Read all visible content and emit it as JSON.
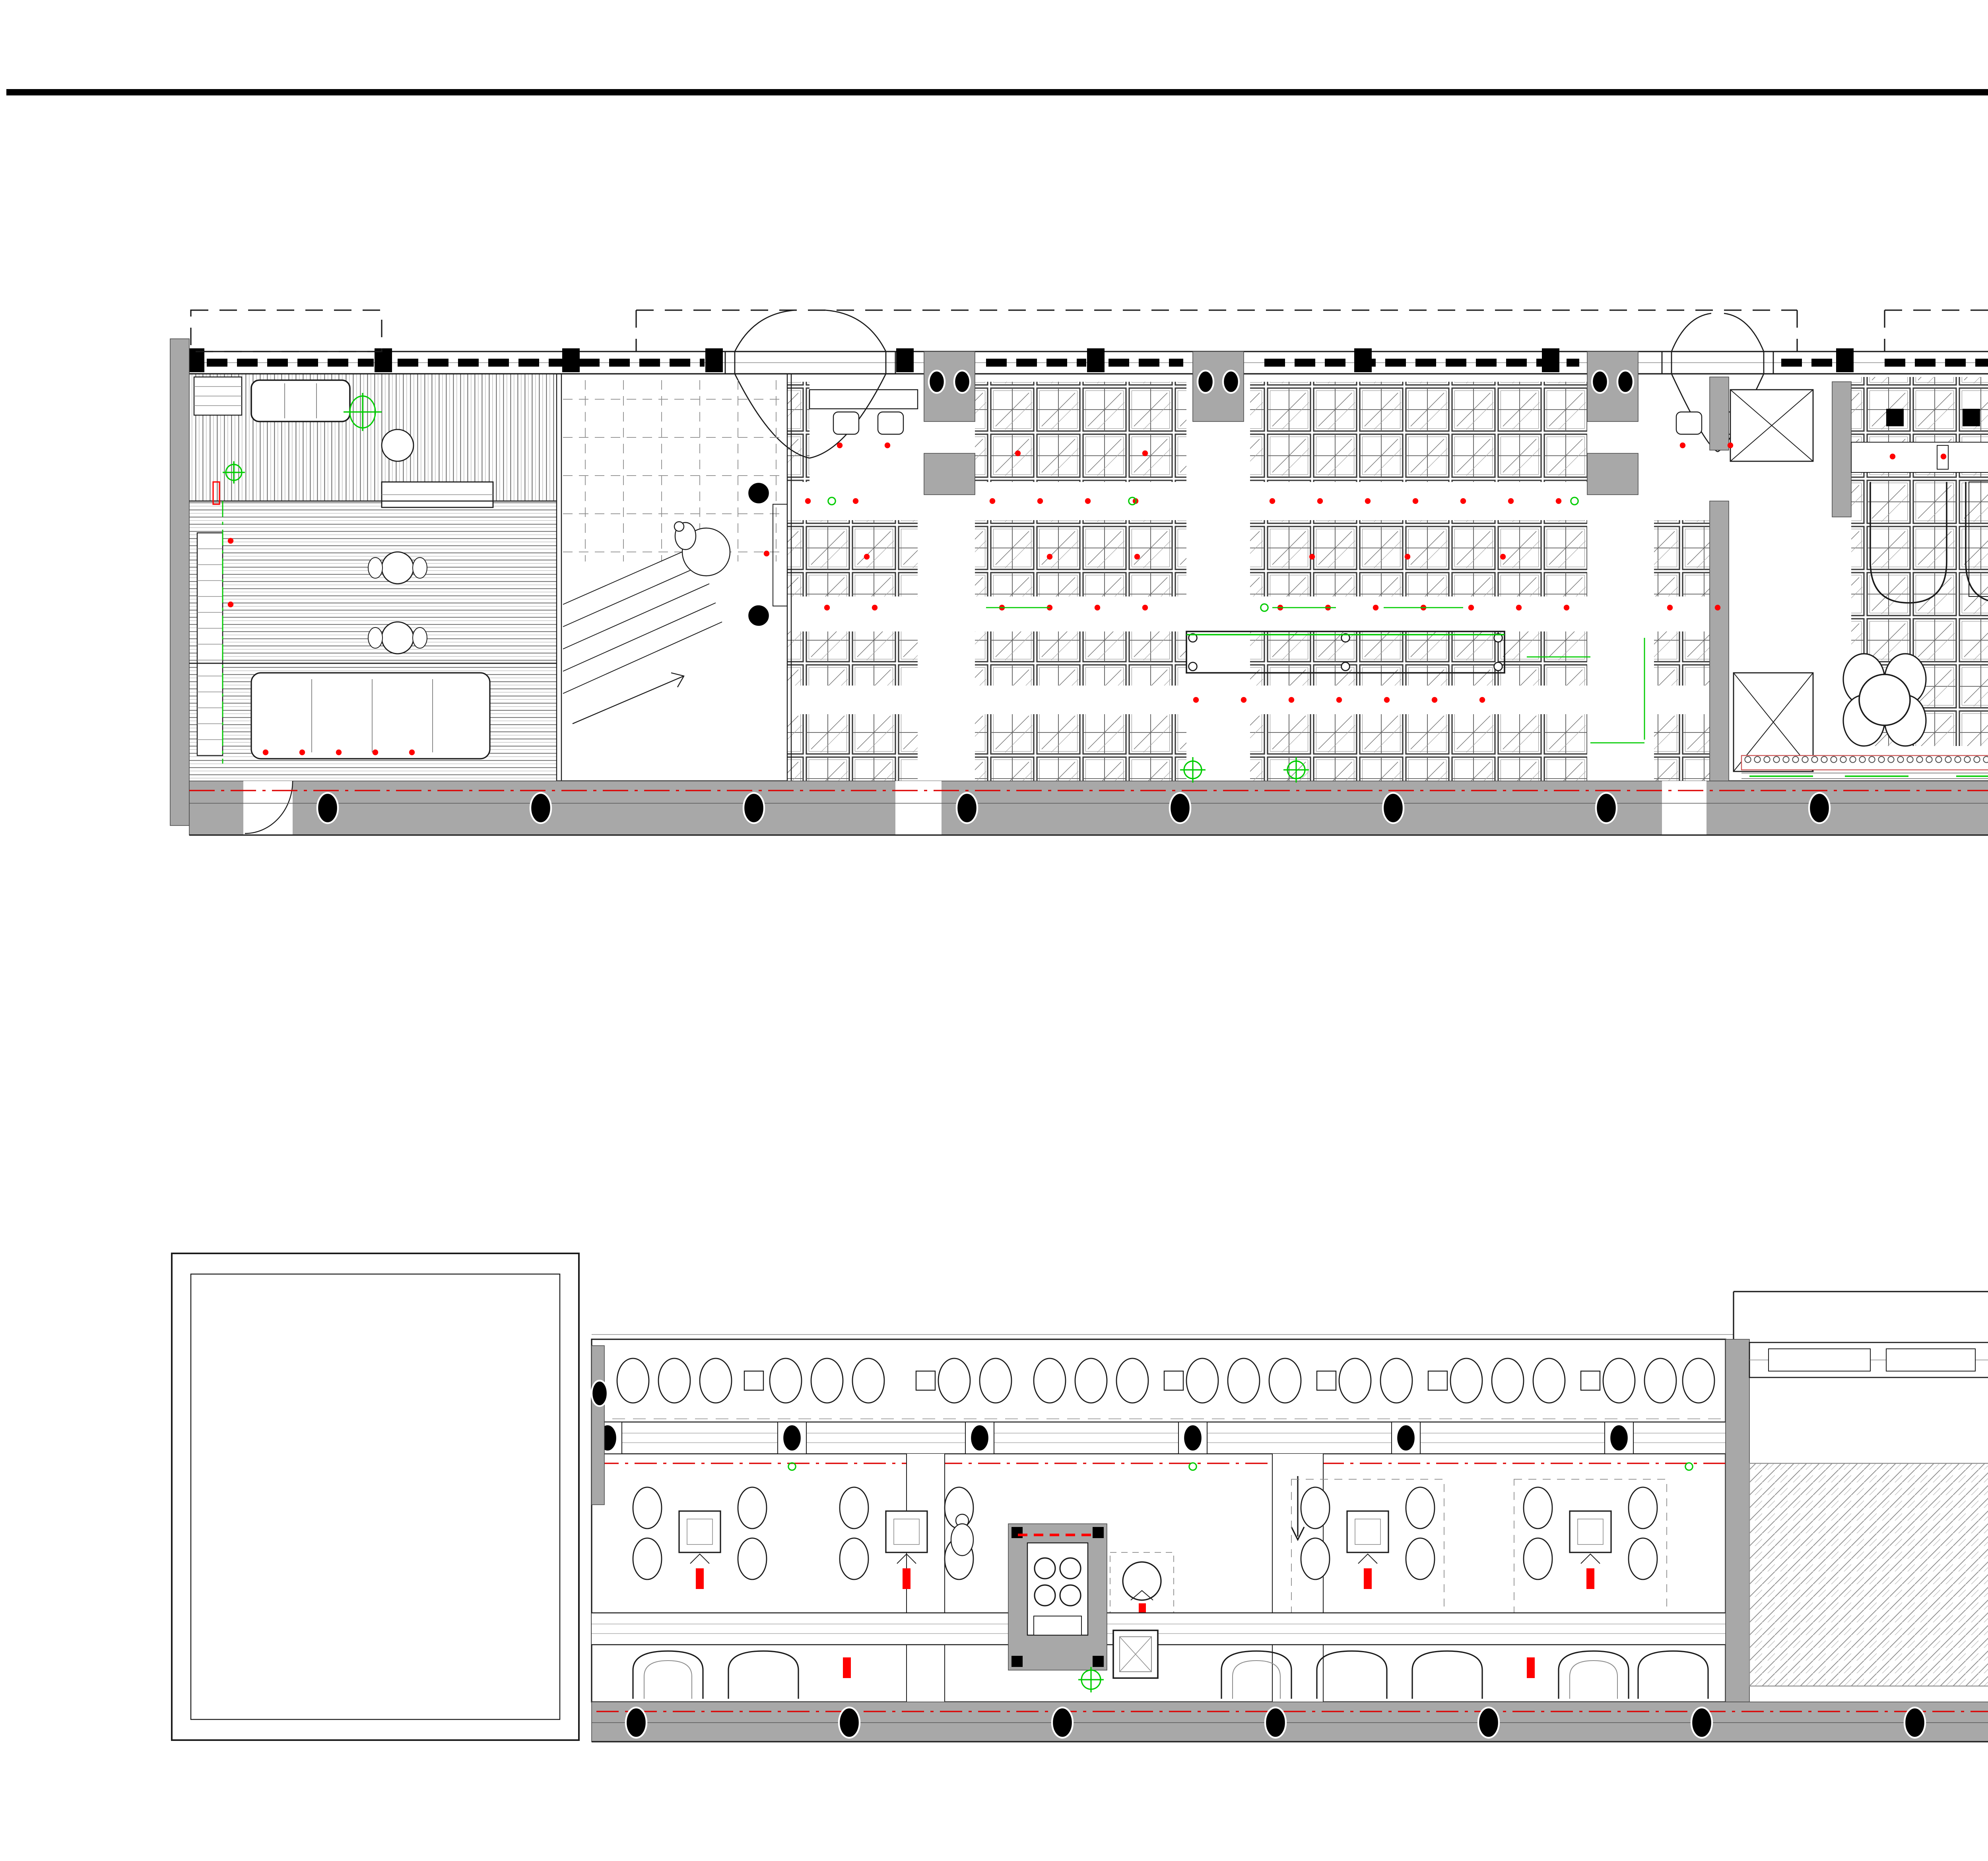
{
  "sheet": {
    "type": "architectural-plan-sheet",
    "background": "#ffffff",
    "top_border_color": "#000000"
  },
  "colors": {
    "wall_fill": "#a8a8a8",
    "accent_red": "#ff0000",
    "dash_red": "#dd0000",
    "accent_green": "#00cc00",
    "line": "#1a1a1a"
  },
  "drawings": [
    {
      "id": "first-floor-plan",
      "title": "首层平面图",
      "scale": "1:50"
    },
    {
      "id": "second-floor-plan",
      "title": "二层平面图",
      "scale": "1:50"
    }
  ]
}
